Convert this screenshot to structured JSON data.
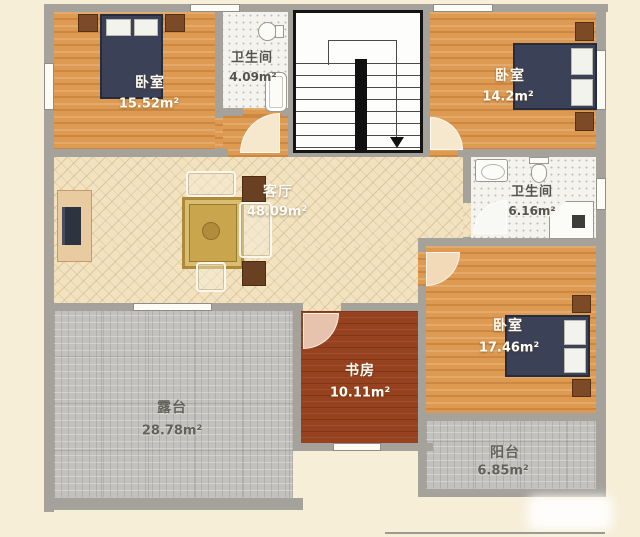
{
  "floor_plan": {
    "type": "residential-floor-plan",
    "rooms": [
      {
        "name": "bedroom-top-left",
        "label": "卧室",
        "area": "15.52m²"
      },
      {
        "name": "bathroom-top",
        "label": "卫生间",
        "area": "4.09m²"
      },
      {
        "name": "bedroom-top-right",
        "label": "卧室",
        "area": "14.2m²"
      },
      {
        "name": "living-room",
        "label": "客厅",
        "area": "48.09m²"
      },
      {
        "name": "bathroom-right",
        "label": "卫生间",
        "area": "6.16m²"
      },
      {
        "name": "bedroom-bottom-right",
        "label": "卧室",
        "area": "17.46m²"
      },
      {
        "name": "study",
        "label": "书房",
        "area": "10.11m²"
      },
      {
        "name": "terrace",
        "label": "露台",
        "area": "28.78m²"
      },
      {
        "name": "balcony",
        "label": "阳台",
        "area": "6.85m²"
      }
    ],
    "stairs": {
      "direction": "down"
    },
    "palette": {
      "background": "#f7eed8",
      "wall": "#a5a29b",
      "wood_floor": "#dd9a50",
      "living_floor": "#f2e2c0",
      "terrace_tile": "#c3c1bd",
      "bath_tile": "#f4f3ee",
      "study_floor": "#97421f",
      "bed": "#3b4157",
      "nightstand": "#7c4a27"
    }
  }
}
